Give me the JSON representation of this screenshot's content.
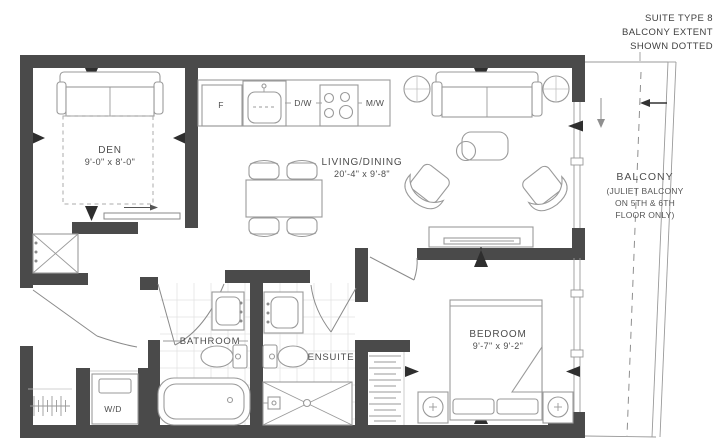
{
  "title_annotation": {
    "lines": [
      "SUITE TYPE 8",
      "BALCONY EXTENT",
      "SHOWN DOTTED"
    ]
  },
  "rooms": {
    "den": {
      "name": "DEN",
      "dims": "9'-0\" x 8'-0\""
    },
    "living_dining": {
      "name": "LIVING/DINING",
      "dims": "20'-4\" x 9'-8\""
    },
    "bedroom": {
      "name": "BEDROOM",
      "dims": "9'-7\" x 9'-2\""
    },
    "bathroom": {
      "name": "BATHROOM"
    },
    "ensuite": {
      "name": "ENSUITE"
    },
    "balcony": {
      "name": "BALCONY",
      "note_lines": [
        "(JULIET BALCONY",
        "ON 5TH & 6TH",
        "FLOOR ONLY)"
      ]
    }
  },
  "appliances": {
    "fridge": "F",
    "dishwasher": "D/W",
    "microwave": "M/W",
    "washer_dryer": "W/D"
  },
  "colors": {
    "wall": "#4a4a4a",
    "furniture_line": "#9a9a9a",
    "text": "#4d4d4d",
    "tile_line": "#e3e3e3",
    "marker": "#2e2e2e"
  }
}
